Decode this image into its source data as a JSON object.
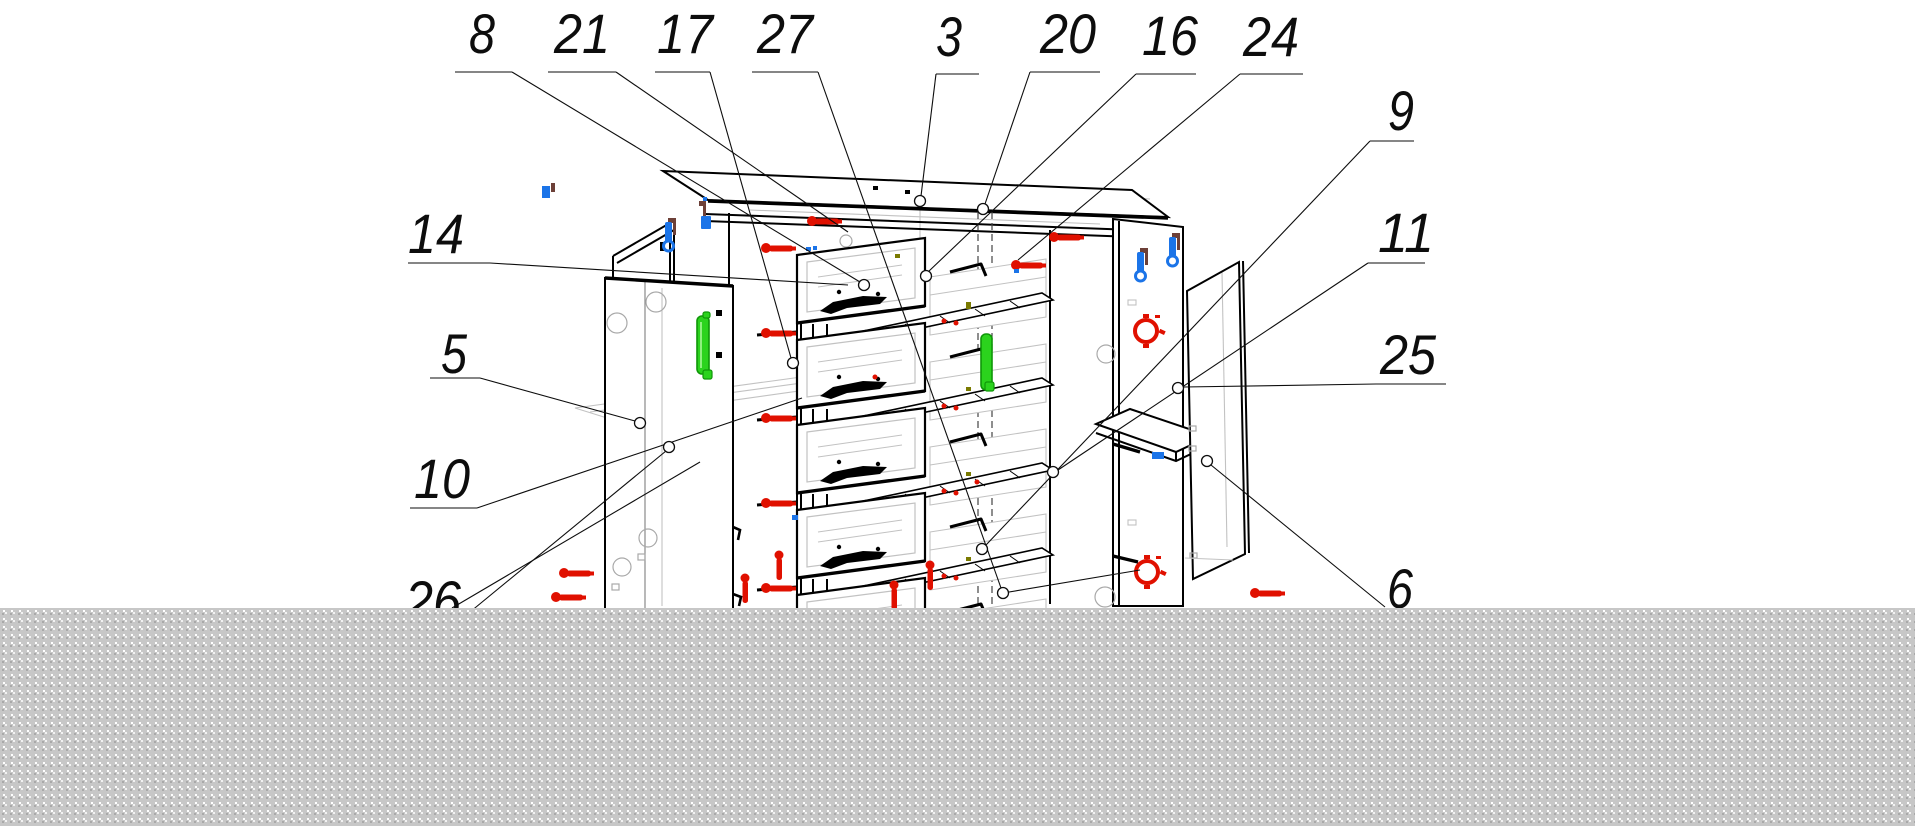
{
  "figure": {
    "kind": "exploded-assembly-diagram",
    "subject": "chest-of-drawers furniture assembly drawing",
    "background": "#ffffff"
  },
  "canvas": {
    "width": 1915,
    "height": 826
  },
  "colors": {
    "outline": "#000000",
    "hidden_line": "#c2c2c2",
    "leader": "#0d0d0d",
    "screw_red": "#e01000",
    "handle_green": "#2bd31d",
    "handle_green_dark": "#0f9708",
    "bracket_blue": "#1b74e8",
    "bracket_brown": "#6d4038",
    "olive_mark": "#7a7a00",
    "mask_base": "#c7c7c7",
    "mask_dot_light": "#ffffff",
    "mask_dot_dark": "#a9a9a9"
  },
  "mask": {
    "x": 0,
    "y": 608,
    "width": 1915,
    "height": 218
  },
  "callouts": [
    {
      "label": "8",
      "tx": 482,
      "ty": 53,
      "underline": [
        455,
        512,
        72
      ],
      "leader": [
        [
          512,
          72
        ],
        [
          860,
          282
        ]
      ],
      "circle": [
        864,
        285
      ]
    },
    {
      "label": "21",
      "tx": 582,
      "ty": 53,
      "underline": [
        548,
        616,
        72
      ],
      "leader": [
        [
          616,
          72
        ],
        [
          848,
          232
        ]
      ],
      "circle": null
    },
    {
      "label": "17",
      "tx": 685,
      "ty": 53,
      "underline": [
        655,
        710,
        72
      ],
      "leader": [
        [
          710,
          72
        ],
        [
          791,
          358
        ]
      ],
      "circle": [
        793,
        363
      ]
    },
    {
      "label": "27",
      "tx": 785,
      "ty": 53,
      "underline": [
        752,
        818,
        72
      ],
      "leader": [
        [
          818,
          72
        ],
        [
          1001,
          588
        ]
      ],
      "circle": [
        1003,
        593
      ]
    },
    {
      "label": "3",
      "tx": 949,
      "ty": 56,
      "underline": [
        936,
        979,
        74
      ],
      "leader": [
        [
          936,
          74
        ],
        [
          921,
          196
        ]
      ],
      "circle": [
        920,
        201
      ]
    },
    {
      "label": "20",
      "tx": 1068,
      "ty": 53,
      "underline": [
        1030,
        1100,
        72
      ],
      "leader": [
        [
          1030,
          72
        ],
        [
          985,
          204
        ]
      ],
      "circle": [
        983,
        209
      ]
    },
    {
      "label": "16",
      "tx": 1170,
      "ty": 55,
      "underline": [
        1136,
        1196,
        74
      ],
      "leader": [
        [
          1136,
          74
        ],
        [
          928,
          272
        ]
      ],
      "circle": [
        926,
        276
      ]
    },
    {
      "label": "24",
      "tx": 1271,
      "ty": 56,
      "underline": [
        1240,
        1303,
        74
      ],
      "leader": [
        [
          1240,
          74
        ],
        [
          1018,
          260
        ]
      ],
      "circle": null
    },
    {
      "label": "9",
      "tx": 1401,
      "ty": 130,
      "underline": [
        1370,
        1414,
        141
      ],
      "leader": [
        [
          1370,
          141
        ],
        [
          986,
          545
        ]
      ],
      "circle": [
        982,
        549
      ]
    },
    {
      "label": "11",
      "tx": 1406,
      "ty": 252,
      "underline": [
        1368,
        1425,
        263
      ],
      "leader": [
        [
          1368,
          263
        ],
        [
          1058,
          470
        ]
      ],
      "circle": [
        1053,
        472
      ]
    },
    {
      "label": "25",
      "tx": 1408,
      "ty": 374,
      "underline": [
        1376,
        1446,
        384
      ],
      "leader": [
        [
          1376,
          384
        ],
        [
          1184,
          387
        ]
      ],
      "circle": [
        1178,
        388
      ]
    },
    {
      "label": "6",
      "tx": 1400,
      "ty": 608,
      "underline": [
        1368,
        1430,
        616
      ],
      "leader": [
        [
          1385,
          607
        ],
        [
          1211,
          465
        ]
      ],
      "circle": [
        1207,
        461
      ]
    },
    {
      "label": "14",
      "tx": 436,
      "ty": 253,
      "underline": [
        408,
        490,
        263
      ],
      "leader": [
        [
          490,
          263
        ],
        [
          848,
          285
        ]
      ],
      "circle": null
    },
    {
      "label": "5",
      "tx": 454,
      "ty": 373,
      "underline": [
        430,
        480,
        378
      ],
      "leader": [
        [
          480,
          378
        ],
        [
          635,
          421
        ]
      ],
      "circle": [
        640,
        423
      ]
    },
    {
      "label": "10",
      "tx": 442,
      "ty": 498,
      "underline": [
        410,
        477,
        508
      ],
      "leader": [
        [
          477,
          508
        ],
        [
          802,
          398
        ]
      ],
      "circle": null
    },
    {
      "label": "26",
      "tx": 433,
      "ty": 620,
      "underline": [
        405,
        470,
        628
      ],
      "leader": [
        [
          470,
          612
        ],
        [
          666,
          451
        ]
      ],
      "circle": [
        669,
        447
      ]
    }
  ]
}
